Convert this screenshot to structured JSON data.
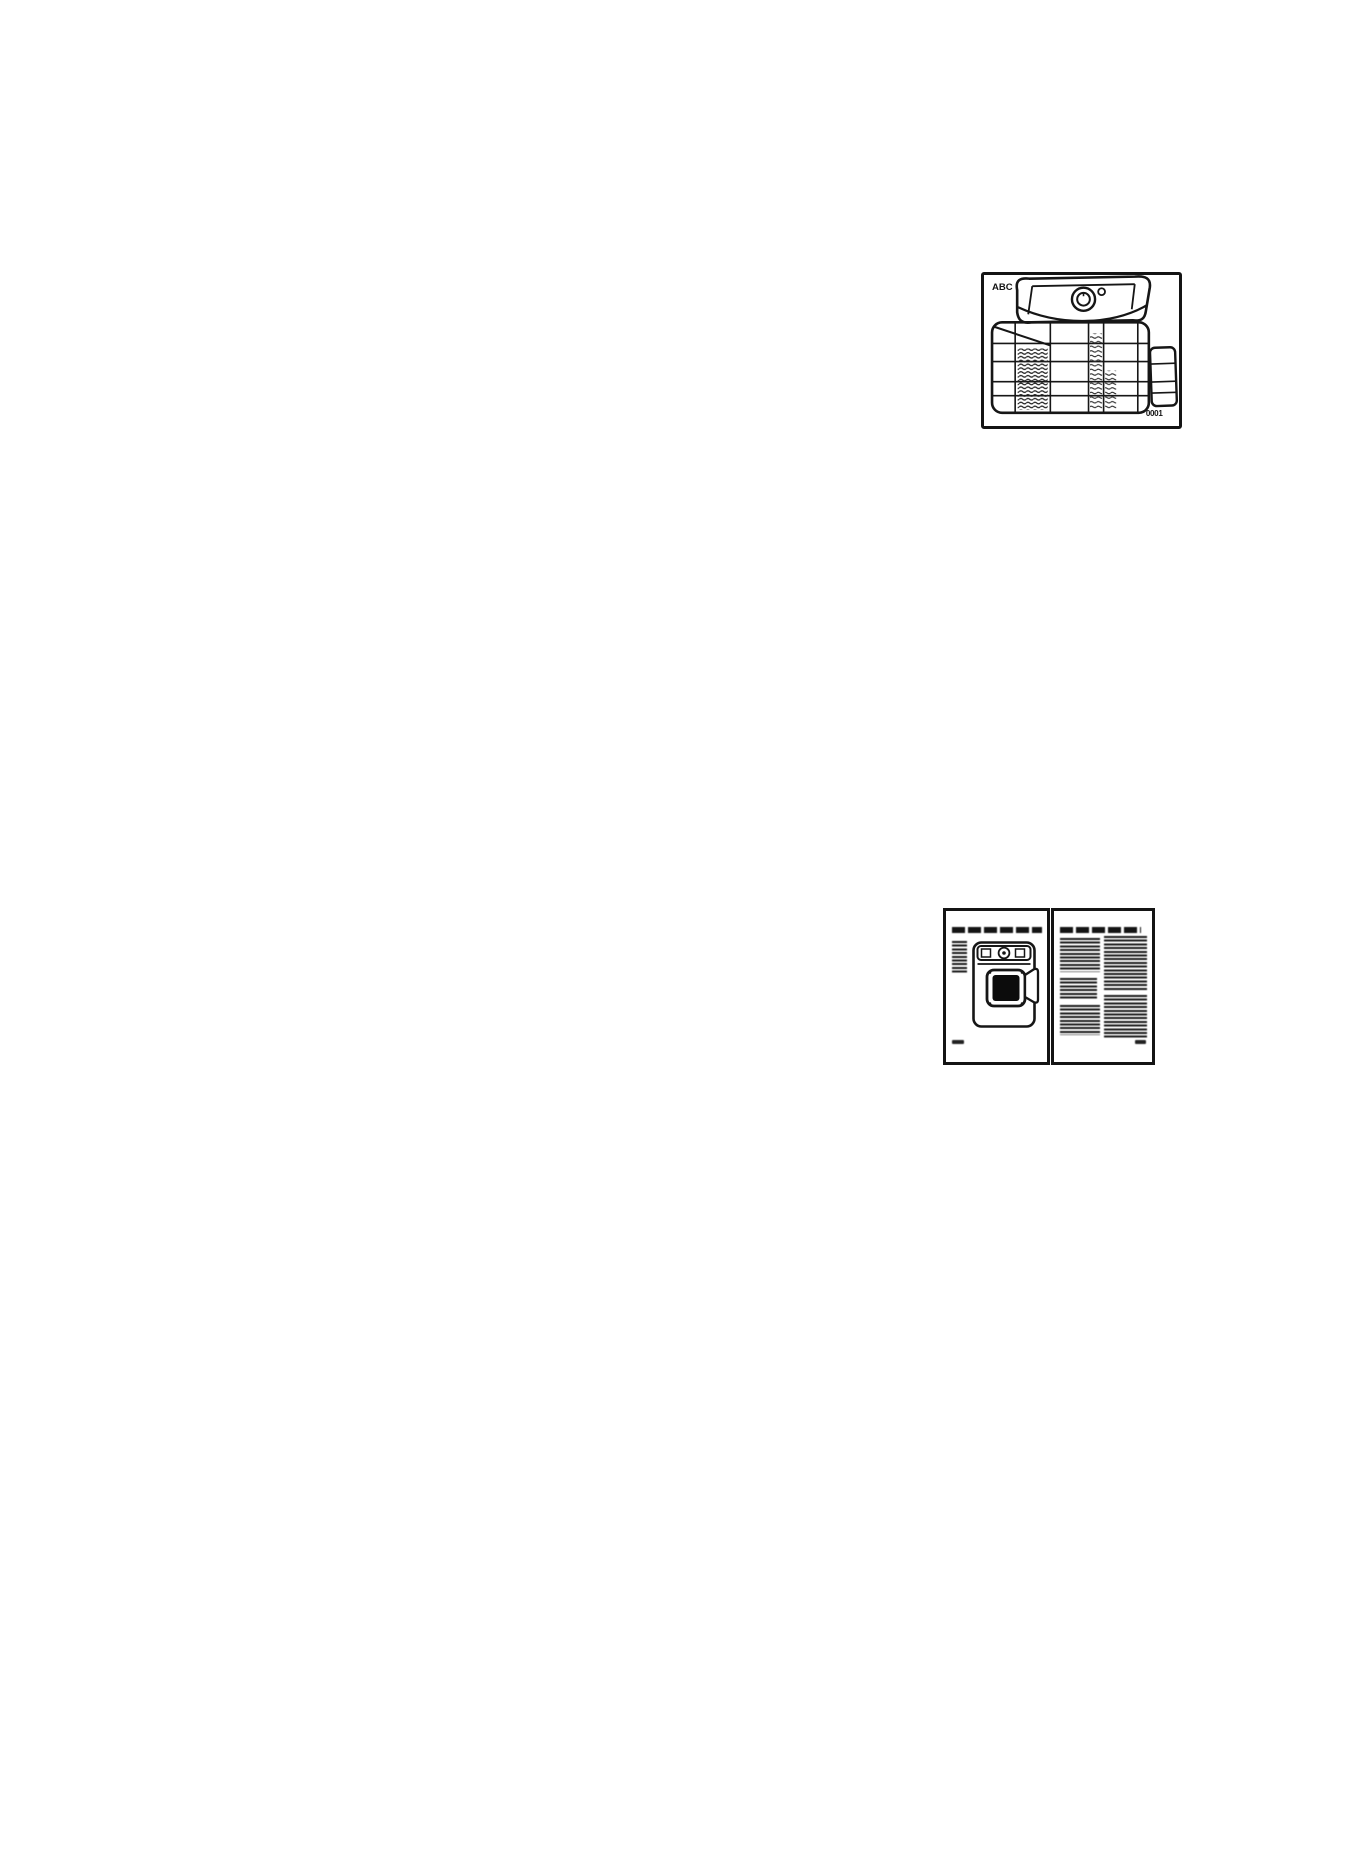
{
  "document": {
    "paper_color": "#ffffff",
    "ink_color": "#161616",
    "figures": {
      "program_label": {
        "brand": "ABC",
        "code": "0001"
      }
    }
  }
}
